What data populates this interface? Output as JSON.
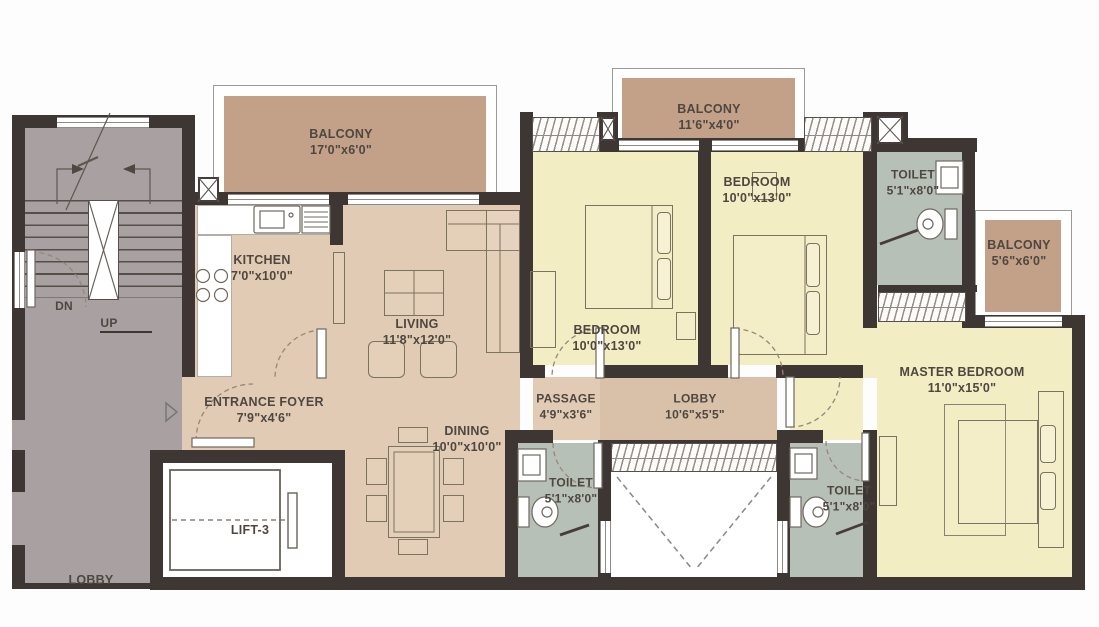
{
  "title": "apartment-floor-plan",
  "colors": {
    "wall": "#3e3633",
    "stairgray": "#a8a0a1",
    "tan": "#e2cbb4",
    "lobbytan": "#d9c0a9",
    "yellow": "#f3edc4",
    "balcony": "#c3a189",
    "toilet": "#b7c0b6",
    "text": "#4e4740"
  },
  "rooms": {
    "balcony_top_left": {
      "name": "BALCONY",
      "dims": "17'0\"x6'0\""
    },
    "balcony_top_middle": {
      "name": "BALCONY",
      "dims": "11'6\"x4'0\""
    },
    "balcony_right": {
      "name": "BALCONY",
      "dims": "5'6\"x6'0\""
    },
    "kitchen": {
      "name": "KITCHEN",
      "dims": "7'0\"x10'0\""
    },
    "living": {
      "name": "LIVING",
      "dims": "11'8\"x12'0\""
    },
    "dining": {
      "name": "DINING",
      "dims": "10'0\"x10'0\""
    },
    "entrance_foyer": {
      "name": "ENTRANCE FOYER",
      "dims": "7'9\"x4'6\""
    },
    "passage": {
      "name": "PASSAGE",
      "dims": "4'9\"x3'6\""
    },
    "lobby": {
      "name": "LOBBY",
      "dims": "10'6\"x5'5\""
    },
    "bedroom_1": {
      "name": "BEDROOM",
      "dims": "10'0\"x13'0\""
    },
    "bedroom_2": {
      "name": "BEDROOM",
      "dims": "10'0\"x13'0\""
    },
    "master_bedroom": {
      "name": "MASTER BEDROOM",
      "dims": "11'0\"x15'0\""
    },
    "toilet_top": {
      "name": "TOILET",
      "dims": "5'1\"x8'0\""
    },
    "toilet_mid": {
      "name": "TOILET",
      "dims": "5'1\"x8'0\""
    },
    "toilet_right": {
      "name": "TOILET",
      "dims": "5'1\"x8'0\""
    },
    "lift": {
      "label": "LIFT-3"
    },
    "stairs": {
      "down": "DN",
      "up": "UP"
    },
    "ground_lobby": {
      "label": "LOBBY"
    }
  }
}
